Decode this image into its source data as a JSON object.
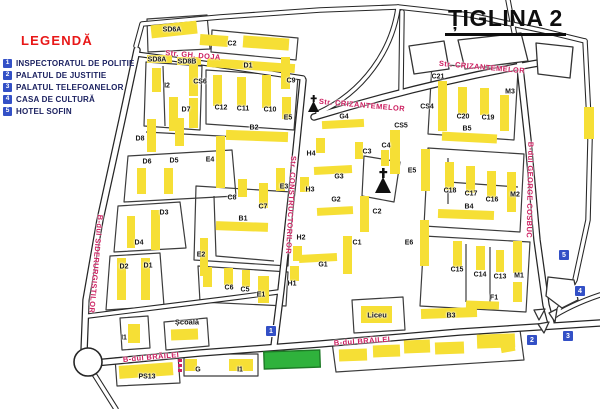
{
  "title": "ȚIGLINA 2",
  "legend": {
    "title": "LEGENDĂ",
    "items": [
      {
        "num": "1",
        "label": "INSPECTORATUL DE POLITIE"
      },
      {
        "num": "2",
        "label": "PALATUL DE JUSTITIE"
      },
      {
        "num": "3",
        "label": "PALATUL TELEFOANELOR"
      },
      {
        "num": "4",
        "label": "CASA DE CULTURĂ"
      },
      {
        "num": "5",
        "label": "HOTEL SOFIN"
      }
    ]
  },
  "streets": {
    "gh_doja": "Str. GH. DOJA",
    "crizantemelor_lower": "Str. CRIZANTEMELOR",
    "crizantemelor_upper": "Str. CRIZANTEMELOR",
    "siderurgistilor": "B-dul SIDERURGISTILOR",
    "constructorilor": "Str. CONSTRUCTORILOR",
    "george_cosbuc": "B-dul GEORGE COSBUC",
    "brailei_left": "B-dul BRĂILEI",
    "brailei_right": "B-dul BRĂILEI"
  },
  "landmarks": {
    "school": "Școală",
    "highschool": "Liceu"
  },
  "map_markers": [
    {
      "num": "1"
    },
    {
      "num": "2"
    },
    {
      "num": "3"
    },
    {
      "num": "4"
    },
    {
      "num": "5"
    }
  ],
  "blocks": [
    "SD6A",
    "C2",
    "SD8A",
    "SD8B",
    "D1",
    "I2",
    "CS6",
    "C9",
    "D7",
    "C12",
    "C11",
    "C10",
    "E5",
    "B2",
    "D8",
    "D6",
    "D5",
    "E4",
    "H4",
    "C3",
    "C4",
    "G4",
    "CS5",
    "G3",
    "E3",
    "H3",
    "C8",
    "C7",
    "D3",
    "G2",
    "C2",
    "B1",
    "D4",
    "H2",
    "C1",
    "D2",
    "D1",
    "G1",
    "E2",
    "C6",
    "C5",
    "E1",
    "H1",
    "E5",
    "E6",
    "C18",
    "C17",
    "C16",
    "M2",
    "B4",
    "C21",
    "CS4",
    "C20",
    "C19",
    "M3",
    "B5",
    "C15",
    "C14",
    "C13",
    "M1",
    "F1",
    "B3",
    "PS13",
    "G",
    "I1",
    "I1"
  ],
  "colors": {
    "building_yellow": "#f6df35",
    "street_name_red": "#cc1f60",
    "legend_red": "#e81717",
    "marker_blue": "#3350c6",
    "police_green": "#2fb23c"
  }
}
